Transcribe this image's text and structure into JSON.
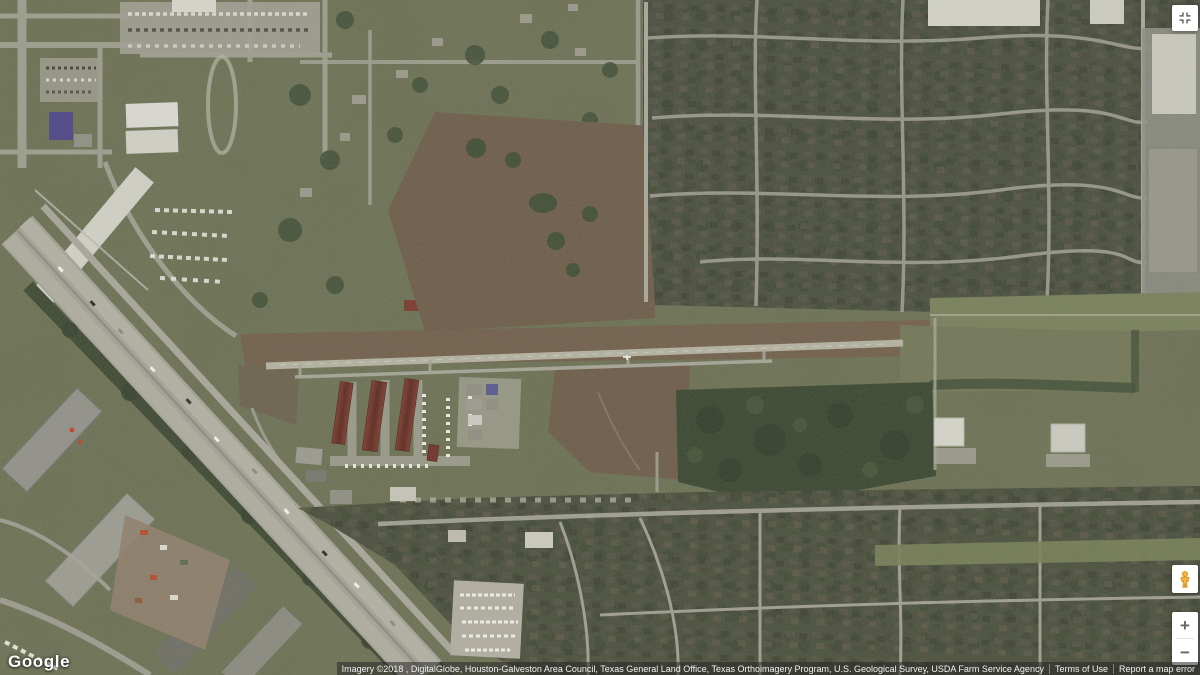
{
  "logo": {
    "text": "Google"
  },
  "controls": {
    "fullscreen": {
      "icon": "fullscreen-icon",
      "tooltip": "Toggle fullscreen view"
    },
    "street_view": {
      "icon": "pegman-icon"
    },
    "zoom": {
      "zoom_in_label": "+",
      "zoom_out_label": "−"
    }
  },
  "attribution": {
    "imagery_credits": "Imagery ©2018 , DigitalGlobe, Houston-Galveston Area Council, Texas General Land Office, Texas Orthoimagery Program, U.S. Geological Survey, USDA Farm Service Agency",
    "terms_label": "Terms of Use",
    "report_label": "Report a map error"
  },
  "map": {
    "view_type": "satellite",
    "colors": {
      "terrain_base": "#6b6f53",
      "neighborhood_dark": "#4b5040",
      "field_brown": "#6e5e4b",
      "forest_green": "#3c4832",
      "road_gray": "#a3a295",
      "highway_pavement": "#a4a296",
      "runway_gray": "#b3b2a1",
      "hangar_red": "#6f352b",
      "warehouse_white": "#d6d6cd",
      "purple_roof": "#4f4787",
      "pegman_orange": "#f6b33a"
    }
  }
}
